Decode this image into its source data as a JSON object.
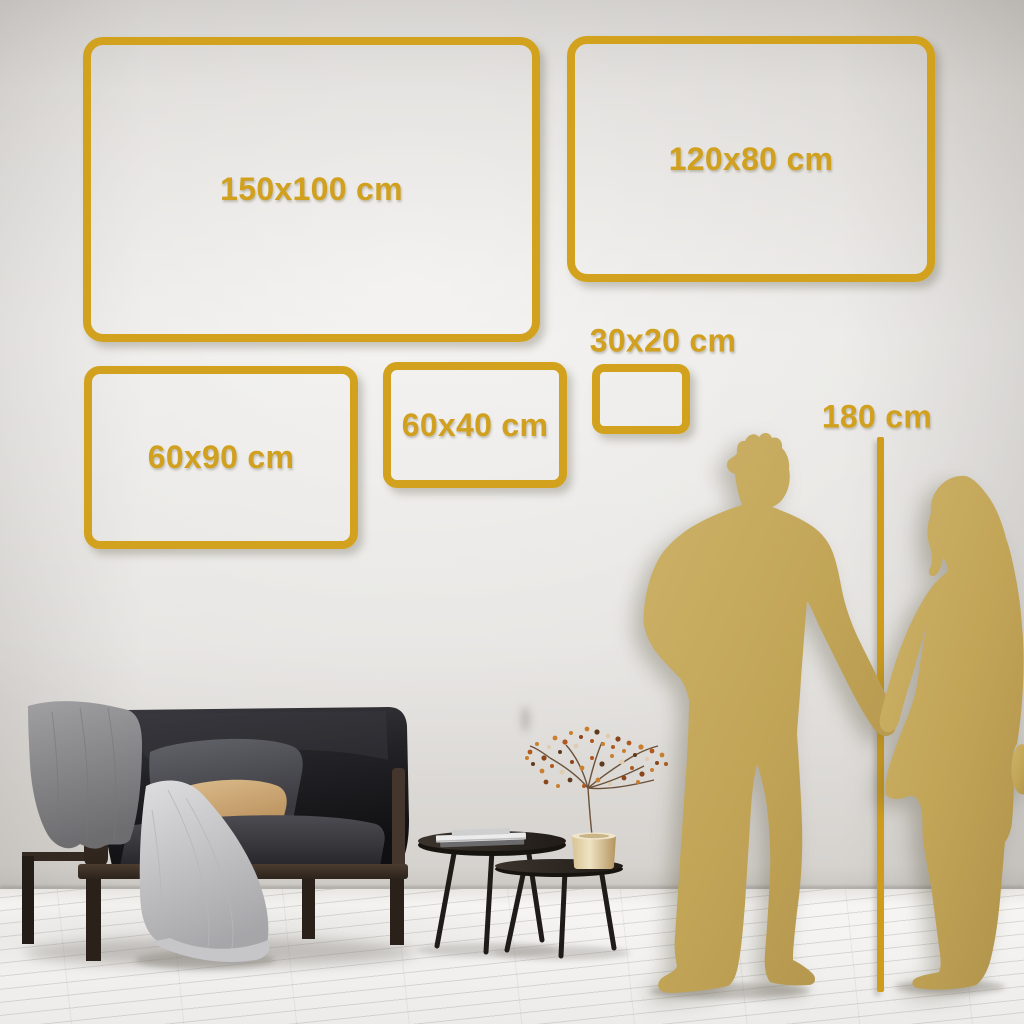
{
  "scene": {
    "type": "wall-art-size-guide",
    "colors": {
      "accent_gold": "#d2a11e",
      "silhouette_gold": "#c2a557",
      "wall": "#e5e3e0",
      "floor": "#f2f1ef"
    }
  },
  "size_frames": [
    {
      "label": "150x100 cm"
    },
    {
      "label": "120x80 cm"
    },
    {
      "label": "60x90 cm"
    },
    {
      "label": "60x40 cm"
    },
    {
      "label": "30x20 cm"
    }
  ],
  "height_reference": {
    "label": "180 cm"
  }
}
